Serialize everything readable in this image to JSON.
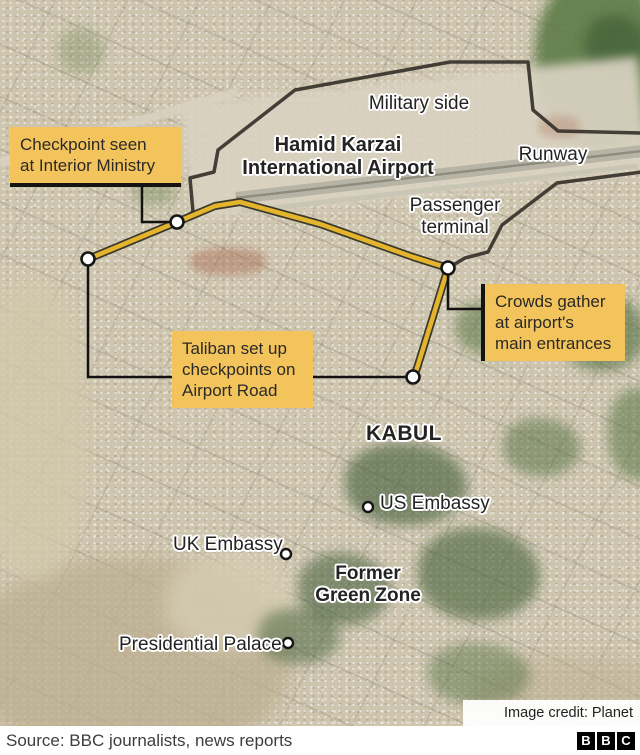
{
  "labels": {
    "military_side": "Military side",
    "airport_line1": "Hamid Karzai",
    "airport_line2": "International Airport",
    "runway": "Runway",
    "terminal_line1": "Passenger",
    "terminal_line2": "terminal",
    "kabul": "KABUL",
    "us_embassy": "US Embassy",
    "uk_embassy": "UK Embassy",
    "green_zone_line1": "Former",
    "green_zone_line2": "Green Zone",
    "presidential_palace": "Presidential Palace"
  },
  "callouts": {
    "checkpoint": {
      "line1": "Checkpoint seen",
      "line2": "at Interior Ministry"
    },
    "taliban": {
      "line1": "Taliban set up",
      "line2": "checkpoints on",
      "line3": "Airport Road"
    },
    "crowds": {
      "line1": "Crowds gather",
      "line2": "at airport's",
      "line3": "main entrances"
    }
  },
  "credit": "Image credit: Planet Labs",
  "footer": {
    "source": "Source: BBC journalists, news reports",
    "logo_letters": {
      "b1": "B",
      "b2": "B",
      "b3": "C"
    }
  },
  "colors": {
    "callout_bg": "#f3c35c",
    "road_fill": "#e3b42c",
    "road_stroke": "#3a372c",
    "perimeter": "#36322a",
    "connector": "#121212"
  }
}
